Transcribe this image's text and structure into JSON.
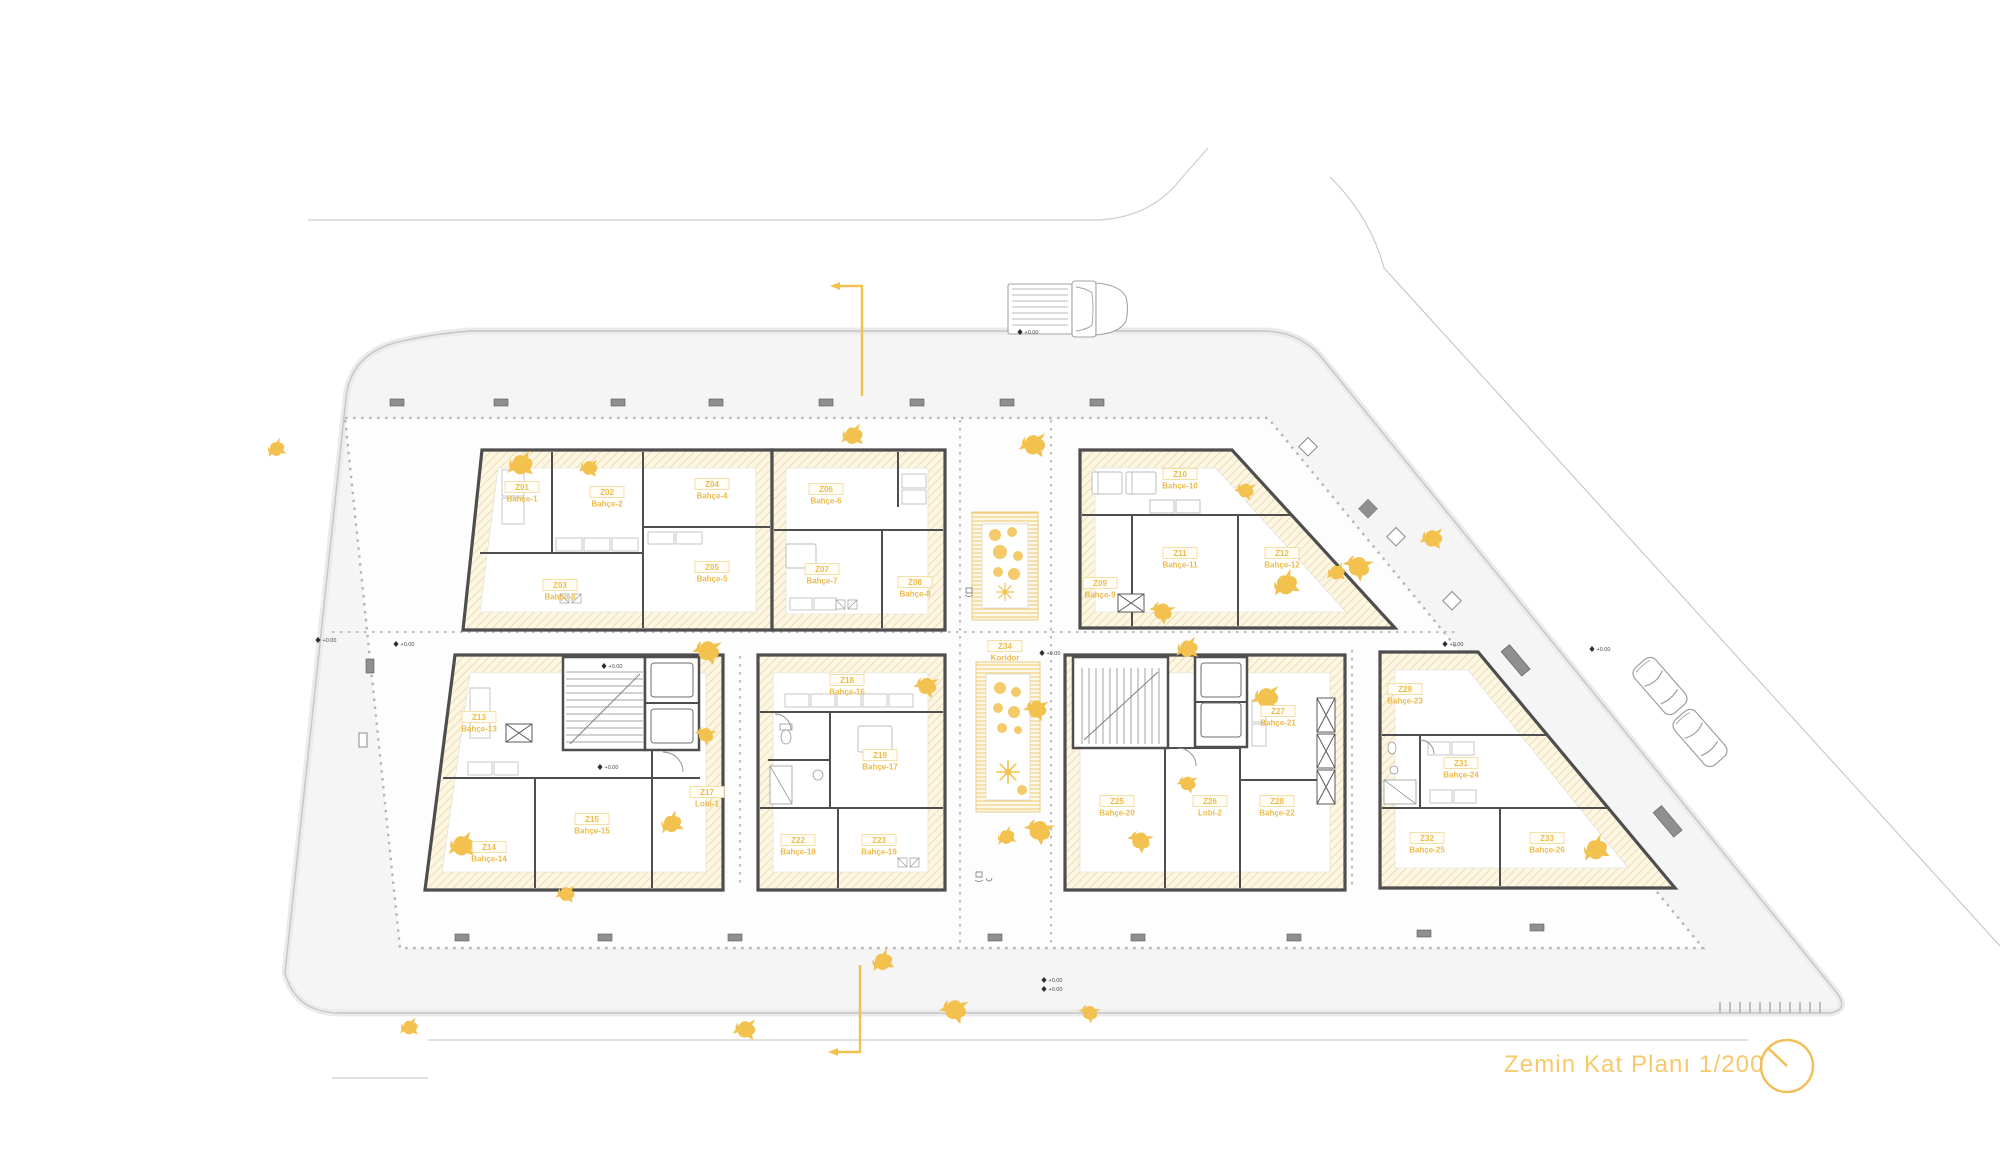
{
  "title": "Zemin Kat Planı 1/200",
  "drawing": {
    "type": "architectural-floor-plan",
    "floor_label": "Zemin Kat Planı",
    "scale": "1/200"
  },
  "colors": {
    "accent_yellow": "#F2C14E",
    "title_yellow": "#F7C96B",
    "terrace_hatch": "#E9D4A4",
    "terrace_tint": "#FCF6E3",
    "wall_dark": "#4E4E4E",
    "site_gray": "#F5F5F6",
    "line_gray": "#C9C9C9"
  },
  "elevation_label": "+0.00",
  "units": [
    {
      "id": "Z01",
      "name": "Bahçe-1",
      "x": 522,
      "y": 495
    },
    {
      "id": "Z02",
      "name": "Bahçe-2",
      "x": 607,
      "y": 500
    },
    {
      "id": "Z03",
      "name": "Bahçe-3",
      "x": 560,
      "y": 593
    },
    {
      "id": "Z04",
      "name": "Bahçe-4",
      "x": 712,
      "y": 492
    },
    {
      "id": "Z05",
      "name": "Bahçe-5",
      "x": 712,
      "y": 575
    },
    {
      "id": "Z06",
      "name": "Bahçe-6",
      "x": 826,
      "y": 497
    },
    {
      "id": "Z07",
      "name": "Bahçe-7",
      "x": 822,
      "y": 577
    },
    {
      "id": "Z08",
      "name": "Bahçe-8",
      "x": 915,
      "y": 590
    },
    {
      "id": "Z09",
      "name": "Bahçe-9",
      "x": 1100,
      "y": 591
    },
    {
      "id": "Z10",
      "name": "Bahçe-10",
      "x": 1180,
      "y": 482
    },
    {
      "id": "Z11",
      "name": "Bahçe-11",
      "x": 1180,
      "y": 561
    },
    {
      "id": "Z12",
      "name": "Bahçe-12",
      "x": 1282,
      "y": 561
    },
    {
      "id": "Z13",
      "name": "Bahçe-13",
      "x": 479,
      "y": 725
    },
    {
      "id": "Z14",
      "name": "Bahçe-14",
      "x": 489,
      "y": 855
    },
    {
      "id": "Z15",
      "name": "Bahçe-15",
      "x": 592,
      "y": 827
    },
    {
      "id": "Z17",
      "name": "Lobi-1",
      "x": 707,
      "y": 800
    },
    {
      "id": "Z18",
      "name": "Bahçe-16",
      "x": 847,
      "y": 688
    },
    {
      "id": "Z19",
      "name": "Bahçe-17",
      "x": 880,
      "y": 763
    },
    {
      "id": "Z22",
      "name": "Bahçe-18",
      "x": 798,
      "y": 848
    },
    {
      "id": "Z23",
      "name": "Bahçe-19",
      "x": 879,
      "y": 848
    },
    {
      "id": "Z25",
      "name": "Bahçe-20",
      "x": 1117,
      "y": 809
    },
    {
      "id": "Z26",
      "name": "Lobi-2",
      "x": 1210,
      "y": 809
    },
    {
      "id": "Z27",
      "name": "Bahçe-21",
      "x": 1278,
      "y": 719
    },
    {
      "id": "Z28",
      "name": "Bahçe-22",
      "x": 1277,
      "y": 809
    },
    {
      "id": "Z29",
      "name": "Bahçe-23",
      "x": 1405,
      "y": 697
    },
    {
      "id": "Z31",
      "name": "Bahçe-24",
      "x": 1461,
      "y": 771
    },
    {
      "id": "Z32",
      "name": "Bahçe-25",
      "x": 1427,
      "y": 846
    },
    {
      "id": "Z33",
      "name": "Bahçe-26",
      "x": 1547,
      "y": 846
    },
    {
      "id": "Z34",
      "name": "Koridor",
      "x": 1005,
      "y": 654
    }
  ],
  "elevation_markers": [
    [
      1020,
      332
    ],
    [
      318,
      640
    ],
    [
      396,
      644
    ],
    [
      604,
      666
    ],
    [
      600,
      767
    ],
    [
      1042,
      653
    ],
    [
      1445,
      644
    ],
    [
      1592,
      649
    ],
    [
      1044,
      980
    ],
    [
      1044,
      989
    ]
  ],
  "birds": [
    [
      270,
      450
    ],
    [
      845,
      435
    ],
    [
      1025,
      442
    ],
    [
      1240,
      487
    ],
    [
      1157,
      606
    ],
    [
      1277,
      586
    ],
    [
      1330,
      572
    ],
    [
      1425,
      536
    ],
    [
      700,
      646
    ],
    [
      701,
      730
    ],
    [
      664,
      825
    ],
    [
      453,
      845
    ],
    [
      560,
      892
    ],
    [
      1030,
      705
    ],
    [
      1033,
      824
    ],
    [
      1000,
      838
    ],
    [
      1180,
      648
    ],
    [
      1258,
      695
    ],
    [
      1182,
      780
    ],
    [
      1135,
      835
    ],
    [
      1587,
      851
    ],
    [
      403,
      1027
    ],
    [
      738,
      1027
    ],
    [
      947,
      1005
    ],
    [
      1085,
      1008
    ],
    [
      875,
      963
    ],
    [
      512,
      464
    ],
    [
      583,
      466
    ],
    [
      920,
      682
    ],
    [
      1352,
      560
    ]
  ],
  "symbols": {
    "north_arrow": "north-arrow-circle",
    "truck": "pickup-truck-top-view",
    "cars": "parked-car-top-view",
    "section_marks": "section-cut-line",
    "bird": "bird-silhouette",
    "plant": "shrub-plant-symbol"
  }
}
